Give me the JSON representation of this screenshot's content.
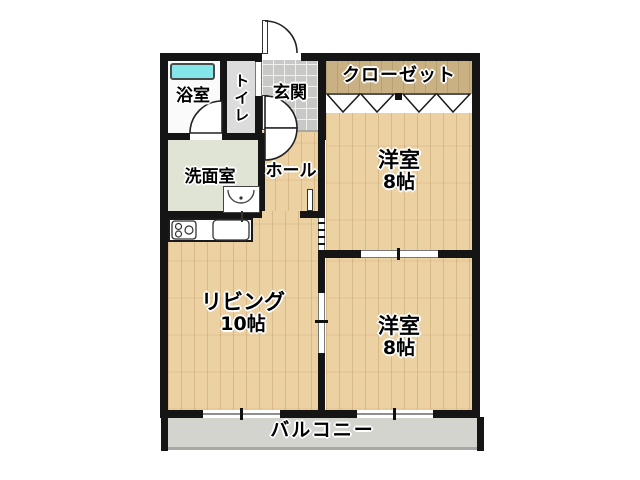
{
  "plan": {
    "rooms": {
      "bathroom": {
        "label": "浴室"
      },
      "toilet": {
        "label": "トイレ"
      },
      "entrance": {
        "label": "玄関"
      },
      "closet": {
        "label": "クローゼット"
      },
      "bedroom_top": {
        "label": "洋室",
        "size": "8帖"
      },
      "washroom": {
        "label": "洗面室"
      },
      "hall": {
        "label": "ホール"
      },
      "living": {
        "label": "リビング",
        "size": "10帖"
      },
      "bedroom_bottom": {
        "label": "洋室",
        "size": "8帖"
      },
      "balcony": {
        "label": "バルコニー"
      }
    },
    "colors": {
      "wall": "#151515",
      "wood_floor": "#ecd1a3",
      "wood_grain": "#97642a",
      "closet_floor": "#c9b184",
      "entrance_tile": "#c8c8c6",
      "washroom_floor": "#dfe4d4",
      "toilet_floor": "#dcdcdc",
      "balcony_floor": "#d3d4ce",
      "bathtub": "#84e6e9",
      "text": "#000000"
    }
  }
}
